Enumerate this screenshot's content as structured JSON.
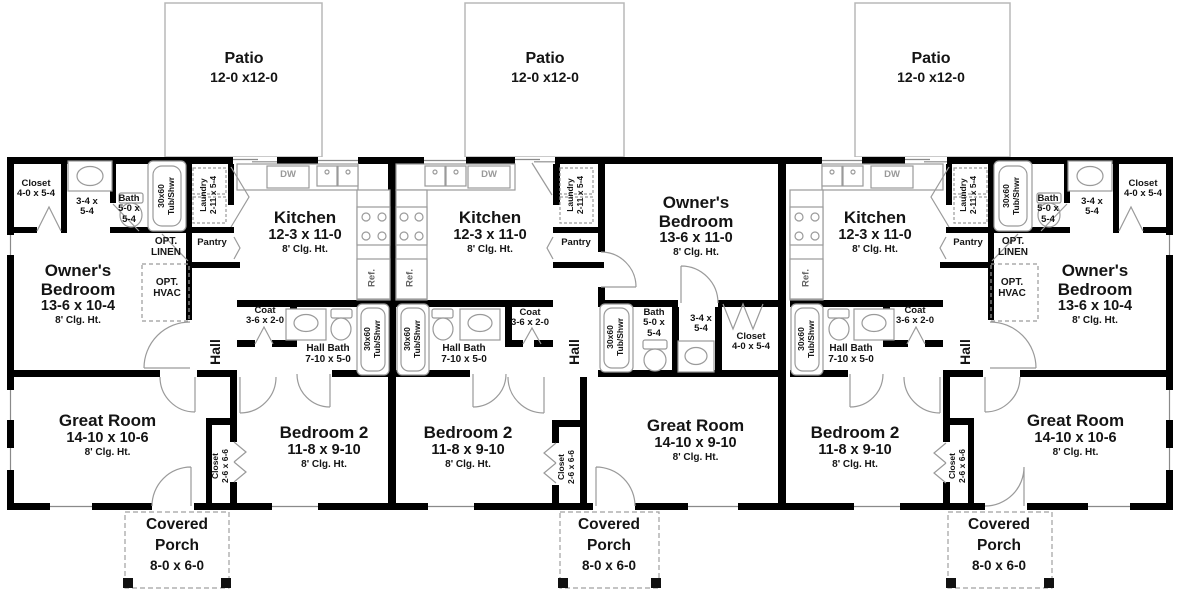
{
  "labels": {
    "patio": "Patio",
    "patio_dim": "12-0 x12-0",
    "porch1": "Covered",
    "porch2": "Porch",
    "porch_dim": "8-0 x 6-0",
    "kitchen": "Kitchen",
    "kitchen_dim": "12-3 x 11-0",
    "clg": "8' Clg. Ht.",
    "owners1": "Owner's",
    "owners2": "Bedroom",
    "great_room": "Great Room",
    "bedroom2": "Bedroom 2",
    "bedroom2_dim": "11-8 x 9-10",
    "hall": "Hall",
    "hall_bath": "Hall Bath",
    "hall_bath_dim": "7-10 x 5-0",
    "bath": "Bath",
    "bath_dim1": "5-0 x",
    "bath_dim2": "5-4",
    "vanity_dim1": "3-4 x",
    "vanity_dim2": "5-4",
    "closet": "Closet",
    "closet_owner_dim": "4-0 x 5-4",
    "closet_b2_dim": "2-6 x 6-6",
    "coat": "Coat",
    "coat_dim": "3-6 x 2-0",
    "laundry": "Laundry",
    "laundry_dim": "2-11 x 5-4",
    "pantry": "Pantry",
    "ref": "Ref.",
    "dw": "DW",
    "tub1": "30x60",
    "tub2": "Tub/Shwr",
    "opt": "OPT.",
    "linen": "LINEN",
    "hvac": "HVAC"
  },
  "units": [
    {
      "position": "left",
      "owners_dim": "13-6 x 10-4",
      "great_dim": "14-10 x 10-6"
    },
    {
      "position": "middle",
      "owners_dim": "13-6 x 11-0",
      "great_dim": "14-10 x 9-10"
    },
    {
      "position": "right",
      "owners_dim": "13-6 x 10-4",
      "great_dim": "14-10 x 10-6"
    }
  ]
}
